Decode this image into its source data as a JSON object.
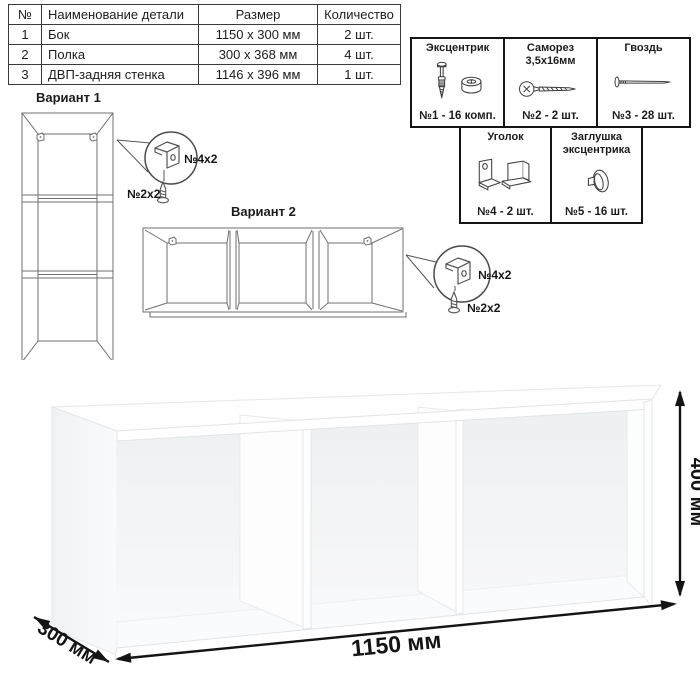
{
  "parts_table": {
    "headers": [
      "№",
      "Наименование детали",
      "Размер",
      "Количество"
    ],
    "rows": [
      {
        "num": "1",
        "name": "Бок",
        "size": "1150 x 300 мм",
        "qty": "2 шт."
      },
      {
        "num": "2",
        "name": "Полка",
        "size": "300 x 368 мм",
        "qty": "4 шт."
      },
      {
        "num": "3",
        "name": "ДВП-задняя стенка",
        "size": "1146 x 396 мм",
        "qty": "1 шт."
      }
    ]
  },
  "hardware": {
    "items": [
      {
        "title": "Эксцентрик",
        "count": "№1 - 16 комп.",
        "icon": "cam-lock-icon"
      },
      {
        "title": "Саморез 3,5х16мм",
        "count": "№2 - 2 шт.",
        "icon": "screw-icon"
      },
      {
        "title": "Гвоздь",
        "count": "№3 - 28 шт.",
        "icon": "nail-icon"
      },
      {
        "title": "Уголок",
        "count": "№4 - 2 шт.",
        "icon": "angle-bracket-icon"
      },
      {
        "title": "Заглушка эксцентрика",
        "count": "№5 - 16 шт.",
        "icon": "cam-cap-icon"
      }
    ]
  },
  "variants": [
    {
      "title": "Вариант 1",
      "bracket_label": "№4х2",
      "screw_label": "№2х2"
    },
    {
      "title": "Вариант 2",
      "bracket_label": "№4х2",
      "screw_label": "№2х2"
    }
  ],
  "dimensions": {
    "width": "1150 мм",
    "depth": "300 мм",
    "height": "400 мм"
  },
  "colors": {
    "line_art": "#6f6f6f",
    "box_border": "#141414",
    "dimension": "#141414"
  }
}
